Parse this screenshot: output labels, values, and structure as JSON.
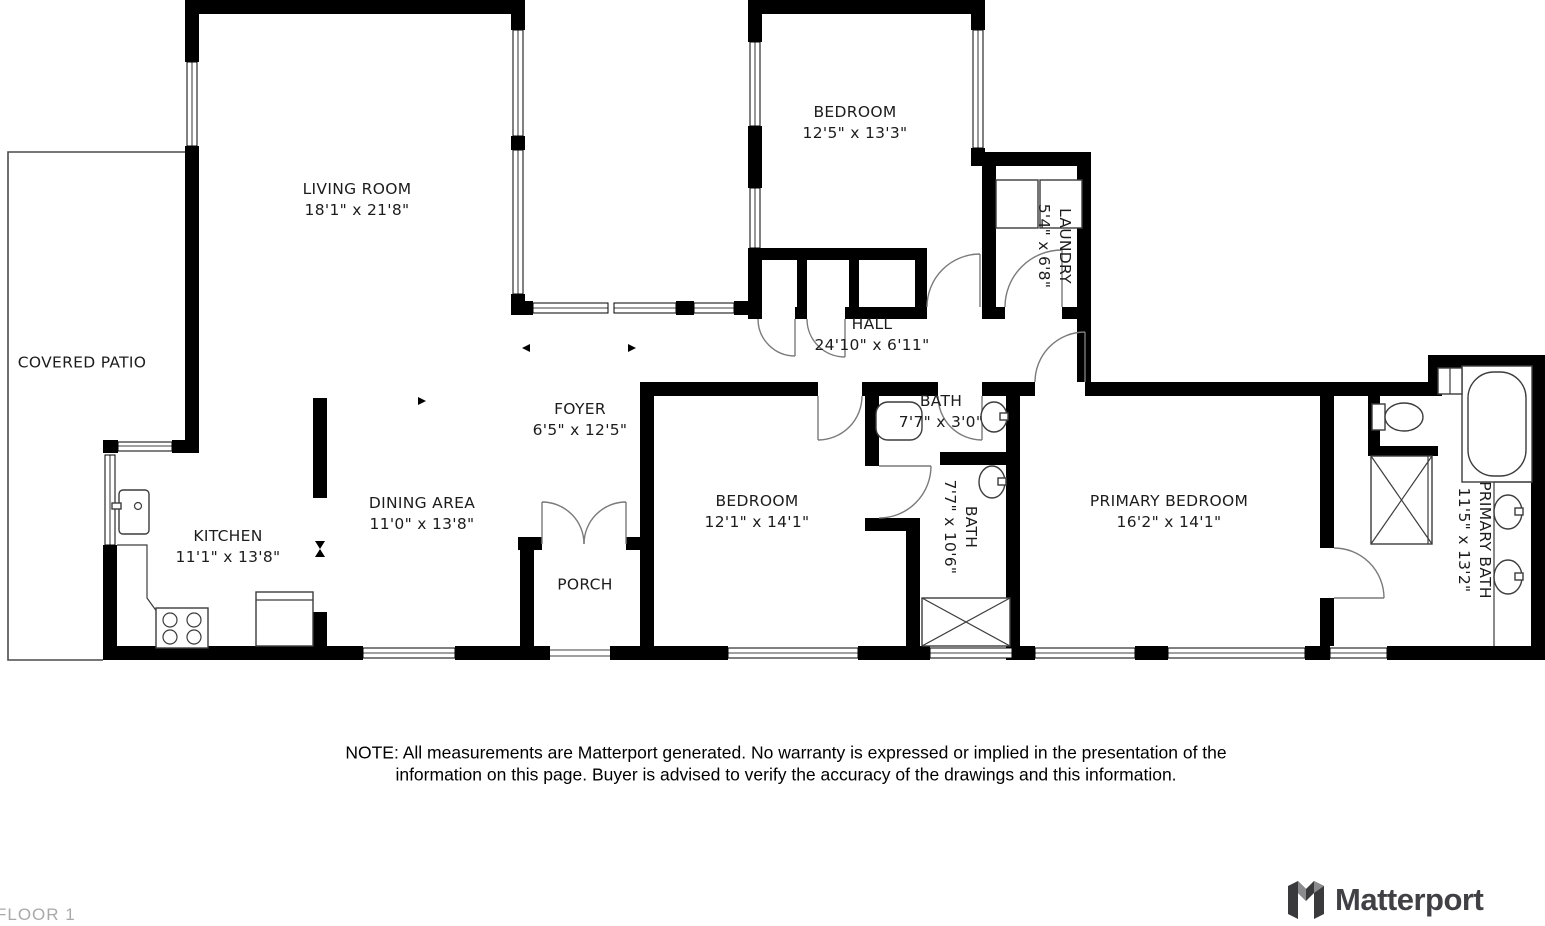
{
  "floor_label": "FLOOR 1",
  "note": {
    "line1": "NOTE: All measurements are Matterport generated. No warranty is expressed or implied in the presentation of the",
    "line2": "information on this page. Buyer is advised to verify the accuracy of the drawings and this information."
  },
  "brand": {
    "name": "Matterport"
  },
  "rooms": [
    {
      "id": "covered-patio",
      "name": "COVERED PATIO",
      "dims": ""
    },
    {
      "id": "living-room",
      "name": "LIVING ROOM",
      "dims": "18'1\" x 21'8\""
    },
    {
      "id": "bedroom",
      "name": "BEDROOM",
      "dims": "12'5\" x 13'3\""
    },
    {
      "id": "laundry",
      "name": "LAUNDRY",
      "dims": "5'4\" x 6'8\""
    },
    {
      "id": "hall",
      "name": "HALL",
      "dims": "24'10\" x 6'11\""
    },
    {
      "id": "foyer",
      "name": "FOYER",
      "dims": "6'5\" x 12'5\""
    },
    {
      "id": "dining-area",
      "name": "DINING AREA",
      "dims": "11'0\" x 13'8\""
    },
    {
      "id": "kitchen",
      "name": "KITCHEN",
      "dims": "11'1\" x 13'8\""
    },
    {
      "id": "porch",
      "name": "PORCH",
      "dims": ""
    },
    {
      "id": "bedroom-2",
      "name": "BEDROOM",
      "dims": "12'1\" x 14'1\""
    },
    {
      "id": "bath",
      "name": "BATH",
      "dims": "7'7\" x 3'0\""
    },
    {
      "id": "bath-2",
      "name": "BATH",
      "dims": "7'7\" x 10'6\""
    },
    {
      "id": "primary-bedroom",
      "name": "PRIMARY BEDROOM",
      "dims": "16'2\" x 14'1\""
    },
    {
      "id": "primary-bath",
      "name": "PRIMARY BATH",
      "dims": "11'5\" x 13'2\""
    }
  ]
}
